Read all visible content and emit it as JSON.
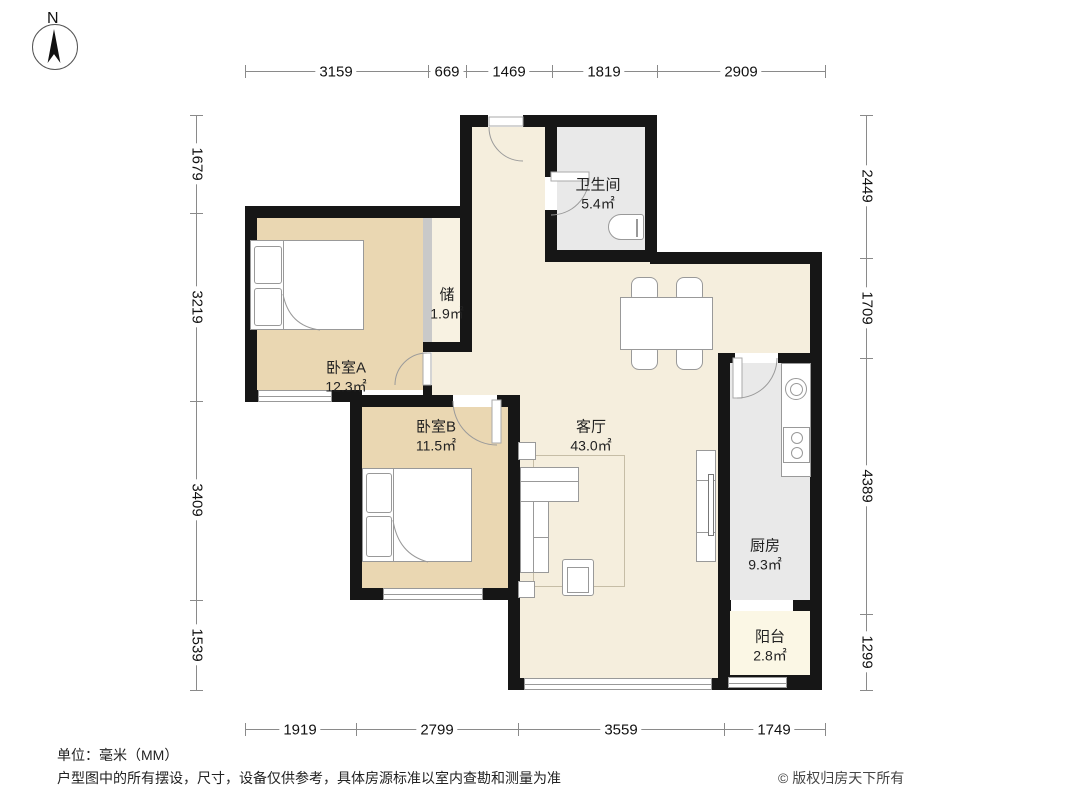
{
  "compass": {
    "label": "N"
  },
  "rooms": {
    "bathroom": {
      "name": "卫生间",
      "area": "5.4㎡"
    },
    "storage": {
      "name": "储",
      "area": "1.9㎡"
    },
    "bedroomA": {
      "name": "卧室A",
      "area": "12.3㎡"
    },
    "bedroomB": {
      "name": "卧室B",
      "area": "11.5㎡"
    },
    "living": {
      "name": "客厅",
      "area": "43.0㎡"
    },
    "kitchen": {
      "name": "厨房",
      "area": "9.3㎡"
    },
    "balcony": {
      "name": "阳台",
      "area": "2.8㎡"
    }
  },
  "dimensions": {
    "top": [
      "3159",
      "669",
      "1469",
      "1819",
      "2909"
    ],
    "bottom": [
      "1919",
      "2799",
      "3559",
      "1749"
    ],
    "left": [
      "1679",
      "3219",
      "3409",
      "1539"
    ],
    "right": [
      "2449",
      "1709",
      "4389",
      "1299"
    ]
  },
  "footer": {
    "unit_note": "单位：毫米（MM）",
    "disclaimer": "户型图中的所有摆设，尺寸，设备仅供参考，具体房源标准以室内查勘和测量为准",
    "copyright": "© 版权归房天下所有"
  },
  "colors": {
    "wall": "#161616",
    "living": "#f5eedd",
    "bedroom": "#ead7b2",
    "service": "#e9e9e9",
    "balcony": "#fbf7e5",
    "storage": "#f8f2e2",
    "stroke": "#999999"
  }
}
